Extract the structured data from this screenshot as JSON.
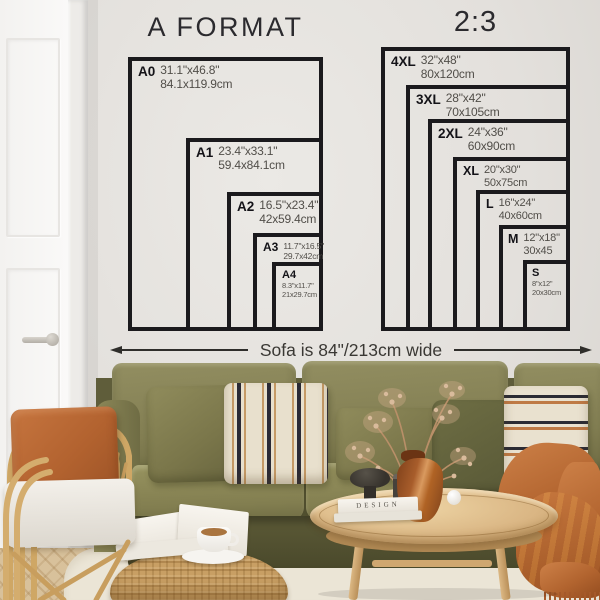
{
  "charts": {
    "a_format": {
      "title": "A FORMAT",
      "sizes": [
        {
          "code": "A0",
          "inches": "31.1\"x46.8\"",
          "cm": "84.1x119.9cm"
        },
        {
          "code": "A1",
          "inches": "23.4\"x33.1\"",
          "cm": "59.4x84.1cm"
        },
        {
          "code": "A2",
          "inches": "16.5\"x23.4\"",
          "cm": "42x59.4cm"
        },
        {
          "code": "A3",
          "inches": "11.7\"x16.5\"",
          "cm": "29.7x42cm"
        },
        {
          "code": "A4",
          "inches": "8.3\"x11.7\"",
          "cm": "21x29.7cm"
        }
      ]
    },
    "two_three": {
      "title": "2:3",
      "sizes": [
        {
          "code": "4XL",
          "inches": "32\"x48\"",
          "cm": "80x120cm"
        },
        {
          "code": "3XL",
          "inches": "28\"x42\"",
          "cm": "70x105cm"
        },
        {
          "code": "2XL",
          "inches": "24\"x36\"",
          "cm": "60x90cm"
        },
        {
          "code": "XL",
          "inches": "20\"x30\"",
          "cm": "50x75cm"
        },
        {
          "code": "L",
          "inches": "16\"x24\"",
          "cm": "40x60cm"
        },
        {
          "code": "M",
          "inches": "12\"x18\"",
          "cm": "30x45"
        },
        {
          "code": "S",
          "inches": "8\"x12\"",
          "cm": "20x30cm"
        }
      ]
    }
  },
  "measure": {
    "label": "Sofa is 84\"/213cm wide"
  },
  "decor": {
    "book_spine": "DESIGN"
  },
  "icons": {
    "measure_arrow_left": "left-triangle",
    "measure_arrow_right": "right-triangle"
  },
  "colors": {
    "wall": "#e3e0dc",
    "chart_line": "#1b1a1d",
    "label_code": "#141318",
    "label_dims": "#514e49",
    "sofa_olive": "#87835a",
    "sofa_dark": "#4a492b",
    "pillow_cream": "#e8e0cd",
    "stripe_navy": "#2a2a36",
    "stripe_tan": "#c59a66",
    "rust": "#b2642f",
    "rattan": "#cfa765",
    "table_wood": "#dab684",
    "rug": "#ebe5d6",
    "vase_amber": "#a85d2b"
  }
}
